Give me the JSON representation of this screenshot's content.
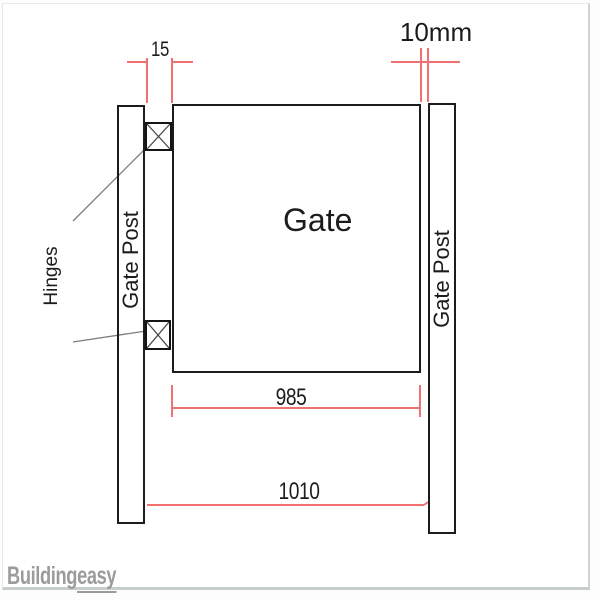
{
  "diagram": {
    "labels": {
      "gate": "Gate",
      "left_post": "Gate Post",
      "right_post": "Gate Post",
      "hinges": "Hinges"
    },
    "dimensions": {
      "hinge_side_gap": "15",
      "latch_side_gap": "10mm",
      "gate_width": "985",
      "opening_width": "1010"
    },
    "colors": {
      "dimension_line_red": "#f17070",
      "drawing_line_black": "#1c1c1c",
      "leader_line_gray": "#7d7d7d",
      "watermark_gray": "#9b9b9b"
    }
  },
  "watermark": {
    "brand_first": "Building",
    "brand_second": "easy"
  }
}
